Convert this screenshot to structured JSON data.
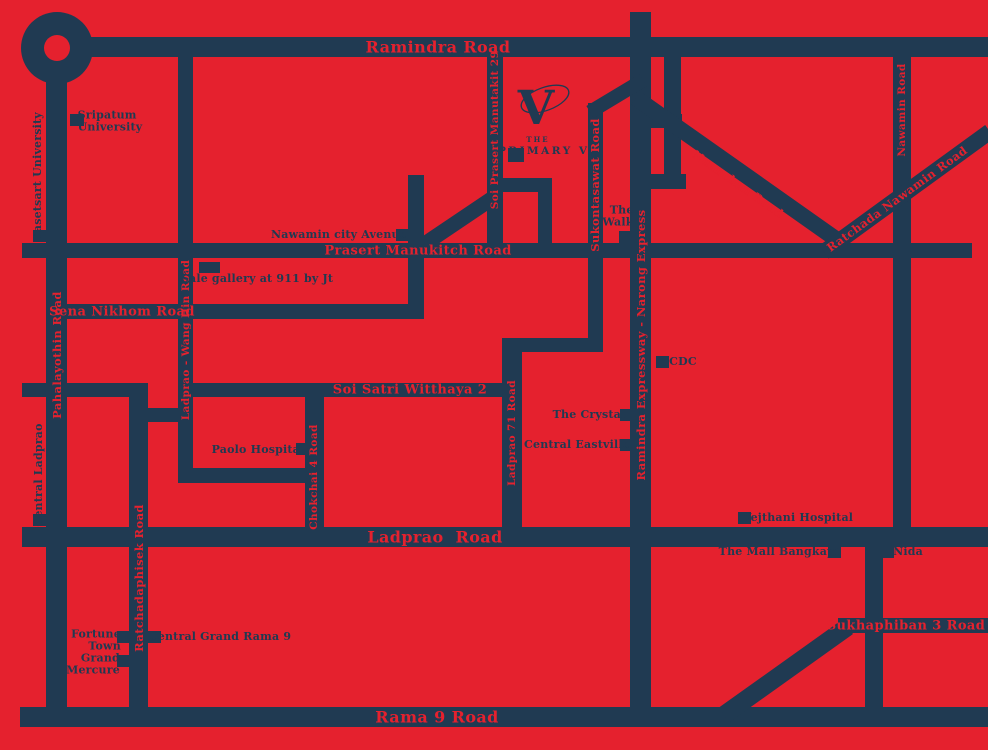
{
  "map": {
    "colors": {
      "background": "#e5212e",
      "road": "#203a52"
    },
    "logo": {
      "the": "THE",
      "name": "PRIMARY V",
      "mark": "V"
    },
    "roundabout": {
      "cx": 57,
      "cy": 48,
      "outer_r": 36,
      "inner_r": 13
    },
    "roads": [
      {
        "id": "ramindra-road",
        "type": "h",
        "x": 60,
        "y": 37,
        "len": 928,
        "t": 20
      },
      {
        "id": "prasert-manukitch-road",
        "type": "h",
        "x": 22,
        "y": 243,
        "len": 950,
        "t": 15
      },
      {
        "id": "sena-nikhom-road",
        "type": "h",
        "x": 46,
        "y": 304,
        "len": 378,
        "t": 15
      },
      {
        "id": "west-soi-stub",
        "type": "h",
        "x": 22,
        "y": 383,
        "len": 126,
        "t": 14
      },
      {
        "id": "soi-satri-witthaya-2",
        "type": "h",
        "x": 182,
        "y": 383,
        "len": 335,
        "t": 14
      },
      {
        "id": "wang-hin-connector",
        "type": "h",
        "x": 129,
        "y": 408,
        "len": 64,
        "t": 14
      },
      {
        "id": "paolo-loop",
        "type": "h",
        "x": 182,
        "y": 468,
        "len": 140,
        "t": 15
      },
      {
        "id": "sukontasawat-link",
        "type": "h",
        "x": 507,
        "y": 338,
        "len": 96,
        "t": 14
      },
      {
        "id": "ladprao-road",
        "type": "h",
        "x": 22,
        "y": 527,
        "len": 966,
        "t": 20
      },
      {
        "id": "sukhaphiban-3-road",
        "type": "h",
        "x": 838,
        "y": 618,
        "len": 150,
        "t": 15
      },
      {
        "id": "rama-9-road",
        "type": "h",
        "x": 20,
        "y": 707,
        "len": 968,
        "t": 20
      },
      {
        "id": "expressway-rung-north",
        "type": "h",
        "x": 640,
        "y": 114,
        "len": 42,
        "t": 14
      },
      {
        "id": "expressway-rung-south",
        "type": "h",
        "x": 644,
        "y": 174,
        "len": 42,
        "t": 15
      },
      {
        "id": "logo-branch",
        "type": "h",
        "x": 494,
        "y": 178,
        "len": 58,
        "t": 14
      },
      {
        "id": "pahalayothin-road",
        "type": "v",
        "x": 46,
        "y": 70,
        "len": 657,
        "t": 21
      },
      {
        "id": "ratchadaphisek-road",
        "type": "v",
        "x": 129,
        "y": 383,
        "len": 344,
        "t": 19
      },
      {
        "id": "ladprao-wang-hin-road",
        "type": "v",
        "x": 178,
        "y": 57,
        "len": 426,
        "t": 15
      },
      {
        "id": "nawamin-city-feeder",
        "type": "v",
        "x": 408,
        "y": 175,
        "len": 144,
        "t": 16
      },
      {
        "id": "soi-prasert-manutakit-29",
        "type": "v",
        "x": 487,
        "y": 56,
        "len": 194,
        "t": 16
      },
      {
        "id": "logo-feeder",
        "type": "v",
        "x": 538,
        "y": 178,
        "len": 80,
        "t": 14
      },
      {
        "id": "sukontasawat-road",
        "type": "v",
        "x": 588,
        "y": 103,
        "len": 249,
        "t": 15
      },
      {
        "id": "ladprao-71-road",
        "type": "v",
        "x": 502,
        "y": 338,
        "len": 192,
        "t": 20
      },
      {
        "id": "chokchai-4-road",
        "type": "v",
        "x": 305,
        "y": 390,
        "len": 137,
        "t": 19
      },
      {
        "id": "ramindra-expressway",
        "type": "v",
        "x": 630,
        "y": 12,
        "len": 715,
        "t": 21
      },
      {
        "id": "expressway-parallel",
        "type": "v",
        "x": 664,
        "y": 56,
        "len": 133,
        "t": 17
      },
      {
        "id": "nawamin-road",
        "type": "v",
        "x": 893,
        "y": 53,
        "len": 478,
        "t": 18
      },
      {
        "id": "bangkapi-south-road",
        "type": "v",
        "x": 865,
        "y": 530,
        "len": 197,
        "t": 18
      },
      {
        "id": "nuanchan-road",
        "type": "d",
        "x": 636,
        "y": 98,
        "len": 250,
        "t": 16,
        "angle": 35.2
      },
      {
        "id": "ratchada-nawamin-road",
        "type": "d",
        "x": 824,
        "y": 252,
        "len": 205,
        "t": 16,
        "angle": -36
      },
      {
        "id": "sukontasawat-diagonal",
        "type": "d",
        "x": 590,
        "y": 112,
        "len": 62,
        "t": 14,
        "angle": -31
      },
      {
        "id": "soi-prasert-diagonal",
        "type": "d",
        "x": 412,
        "y": 252,
        "len": 105,
        "t": 15,
        "angle": -34
      },
      {
        "id": "rama9-sukhaphiban-diagonal",
        "type": "d",
        "x": 724,
        "y": 715,
        "len": 152,
        "t": 18,
        "angle": -35.5
      }
    ],
    "road_labels": [
      {
        "text": "Ramindra Road",
        "cx": 438,
        "cy": 47,
        "size": 16
      },
      {
        "text": "Prasert Manukitch Road",
        "cx": 418,
        "cy": 251,
        "size": 13
      },
      {
        "text": "Sena Nikhom Road",
        "cx": 122,
        "cy": 312,
        "size": 13
      },
      {
        "text": "Soi Satri Witthaya 2",
        "cx": 410,
        "cy": 390,
        "size": 13
      },
      {
        "text": "Ladprao  Road",
        "cx": 435,
        "cy": 537,
        "size": 16
      },
      {
        "text": "Sukhaphiban 3 Road",
        "cx": 906,
        "cy": 626,
        "size": 13
      },
      {
        "text": "Rama 9 Road",
        "cx": 437,
        "cy": 717,
        "size": 16
      },
      {
        "text": "Pahalayothin Road",
        "cx": 57,
        "cy": 355,
        "size": 11.5,
        "rot": -90
      },
      {
        "text": "Ratchadaphisek Road",
        "cx": 139,
        "cy": 578,
        "size": 11.5,
        "rot": -90
      },
      {
        "text": "Ladprao - Wang Hin Road",
        "cx": 186,
        "cy": 340,
        "size": 10.5,
        "rot": -90
      },
      {
        "text": "Chokchai 4 Road",
        "cx": 314,
        "cy": 477,
        "size": 10.5,
        "rot": -90
      },
      {
        "text": "Soi Prasert Manutakit 29",
        "cx": 495,
        "cy": 130,
        "size": 10.5,
        "rot": -90
      },
      {
        "text": "Sukontasawat Road",
        "cx": 595,
        "cy": 185,
        "size": 11.5,
        "rot": -90
      },
      {
        "text": "Ladprao 71 Road",
        "cx": 512,
        "cy": 433,
        "size": 10.5,
        "rot": -90
      },
      {
        "text": "Ramindra Expressway - Narong Express",
        "cx": 641,
        "cy": 345,
        "size": 11.5,
        "rot": -90
      },
      {
        "text": "Nawamin Road",
        "cx": 902,
        "cy": 110,
        "size": 10.5,
        "rot": -90
      },
      {
        "text": "Nuanchan Road",
        "cx": 738,
        "cy": 184,
        "size": 11.5,
        "rot": 35
      },
      {
        "text": "Ratchada Nawamin Road",
        "cx": 897,
        "cy": 199,
        "size": 11.5,
        "rot": -36
      }
    ],
    "landmarks": [
      {
        "id": "kasetsart-university",
        "lines": [
          "Kasetsart University"
        ],
        "cx": 38,
        "cy": 177,
        "rot": -90,
        "marker": {
          "x": 33,
          "y": 230,
          "w": 13,
          "h": 12
        }
      },
      {
        "id": "sripatum-university",
        "lines": [
          "Sripatum",
          "University"
        ],
        "cx": 110,
        "cy": 122,
        "align": "left",
        "marker": {
          "x": 70,
          "y": 114,
          "w": 14,
          "h": 12
        }
      },
      {
        "id": "nawamin-city-avenue",
        "lines": [
          "Nawamin city Avenue"
        ],
        "cx": 339,
        "cy": 235,
        "marker": {
          "x": 396,
          "y": 229,
          "w": 13,
          "h": 12
        }
      },
      {
        "id": "sale-gallery",
        "lines": [
          "Sale gallery at 911 by Jt"
        ],
        "cx": 257,
        "cy": 279,
        "marker": {
          "x": 199,
          "y": 262,
          "w": 21,
          "h": 11
        }
      },
      {
        "id": "the-walk",
        "lines": [
          "The",
          "Walk"
        ],
        "cx": 618,
        "cy": 217,
        "align": "right",
        "marker": {
          "x": 619,
          "y": 231,
          "w": 13,
          "h": 12
        }
      },
      {
        "id": "cdc",
        "lines": [
          "CDC"
        ],
        "cx": 683,
        "cy": 362,
        "marker": {
          "x": 656,
          "y": 356,
          "w": 13,
          "h": 12
        }
      },
      {
        "id": "the-crystal",
        "lines": [
          "The Crystal"
        ],
        "cx": 589,
        "cy": 415,
        "marker": {
          "x": 620,
          "y": 409,
          "w": 13,
          "h": 12
        }
      },
      {
        "id": "central-eastville",
        "lines": [
          "Central Eastville"
        ],
        "cx": 577,
        "cy": 445,
        "marker": {
          "x": 620,
          "y": 439,
          "w": 13,
          "h": 12
        }
      },
      {
        "id": "vejthani-hospital",
        "lines": [
          "Vejthani Hospital"
        ],
        "cx": 798,
        "cy": 518,
        "marker": {
          "x": 738,
          "y": 512,
          "w": 13,
          "h": 12
        }
      },
      {
        "id": "the-mall-bangkapi",
        "lines": [
          "The Mall Bangkapi"
        ],
        "cx": 779,
        "cy": 552,
        "marker": {
          "x": 828,
          "y": 546,
          "w": 13,
          "h": 12
        }
      },
      {
        "id": "nida",
        "lines": [
          "Nida"
        ],
        "cx": 908,
        "cy": 552,
        "marker": {
          "x": 881,
          "y": 546,
          "w": 13,
          "h": 12
        }
      },
      {
        "id": "central-ladprao",
        "lines": [
          "Central Ladprao"
        ],
        "cx": 39,
        "cy": 475,
        "rot": -90,
        "marker": {
          "x": 33,
          "y": 514,
          "w": 13,
          "h": 12
        }
      },
      {
        "id": "paolo-hospital",
        "lines": [
          "Paolo Hospital"
        ],
        "cx": 258,
        "cy": 450,
        "marker": {
          "x": 296,
          "y": 443,
          "w": 13,
          "h": 12
        }
      },
      {
        "id": "fortune-town",
        "lines": [
          "Fortune",
          "Town"
        ],
        "cx": 96,
        "cy": 641,
        "align": "right",
        "marker": {
          "x": 117,
          "y": 631,
          "w": 13,
          "h": 12
        }
      },
      {
        "id": "grand-mercure",
        "lines": [
          "Grand",
          "Mercure"
        ],
        "cx": 93,
        "cy": 665,
        "align": "right",
        "marker": {
          "x": 117,
          "y": 655,
          "w": 13,
          "h": 12
        }
      },
      {
        "id": "central-grand-rama-9",
        "lines": [
          "Central Grand Rama 9"
        ],
        "cx": 220,
        "cy": 637,
        "marker": {
          "x": 148,
          "y": 631,
          "w": 13,
          "h": 12
        }
      },
      {
        "id": "the-primary-v",
        "lines": [],
        "marker": {
          "x": 508,
          "y": 148,
          "w": 16,
          "h": 14
        }
      }
    ]
  }
}
